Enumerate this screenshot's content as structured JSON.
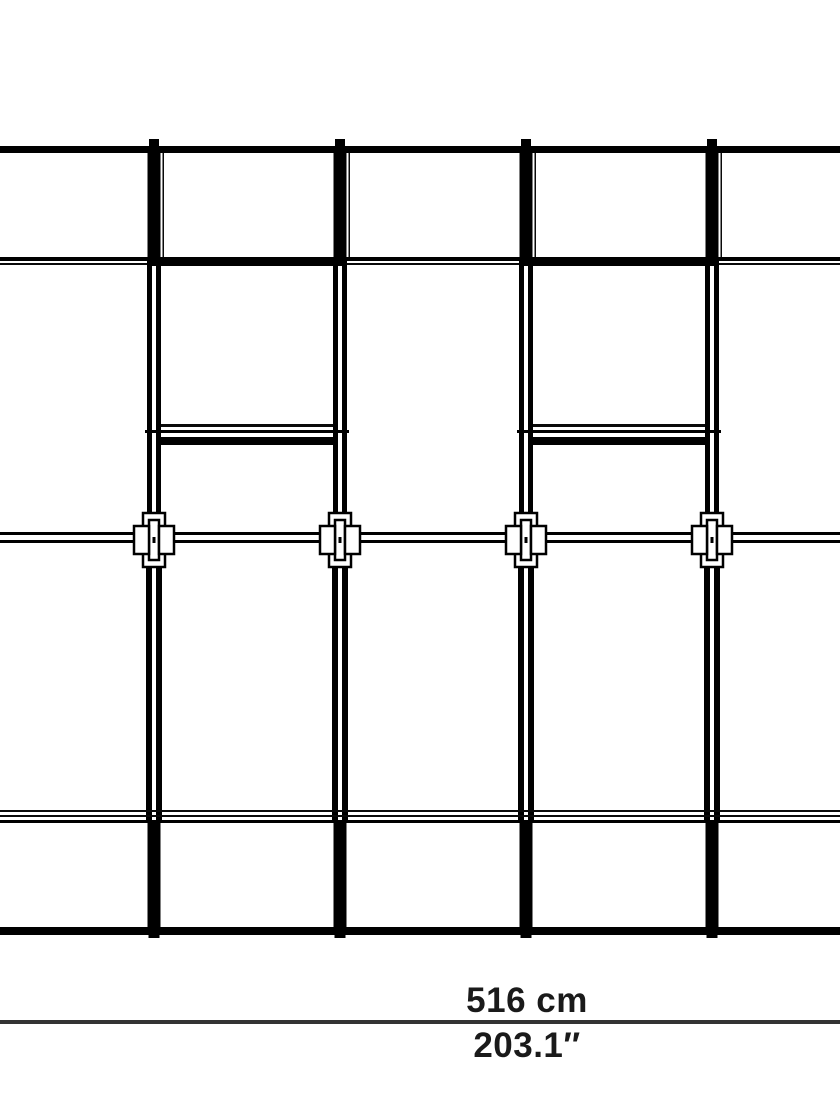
{
  "drawing": {
    "kind": "frame-elevation-drawing",
    "posts": 4,
    "cross_connectors": 4,
    "shelf_bays": 2
  },
  "annotation": {
    "width_metric": "516 cm",
    "width_imperial": "203.1″"
  },
  "colors": {
    "line": "#000000",
    "dimension_line": "#333333",
    "label_text": "#1a1a1a",
    "background": "#ffffff"
  }
}
